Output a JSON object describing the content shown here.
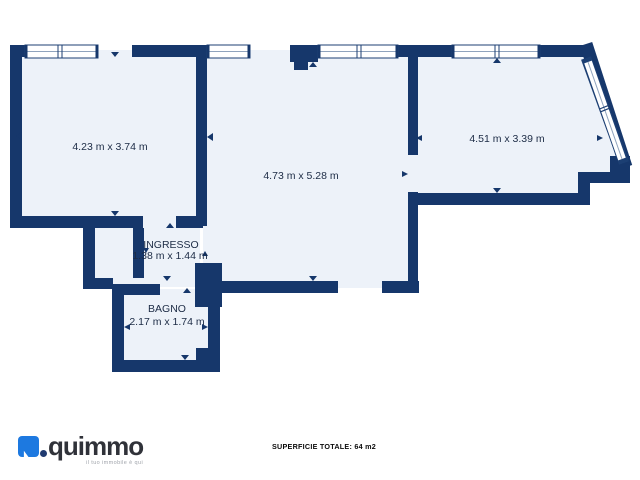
{
  "floorplan": {
    "rooms": [
      {
        "name": "",
        "label": "4.23 m x 3.74 m"
      },
      {
        "name": "",
        "label": "4.73 m x 5.28 m"
      },
      {
        "name": "",
        "label": "4.51 m x 3.39 m"
      },
      {
        "name": "INGRESSO",
        "label": "1.38 m x 1.44 m"
      },
      {
        "name": "BAGNO",
        "label": "2.17 m x 1.74 m"
      }
    ],
    "total_label": "SUPERFICIE TOTALE: 64 m2"
  },
  "branding": {
    "name": "quimmo",
    "tagline": "il tuo immobile è qui"
  },
  "colors": {
    "wall": "#16376b",
    "room_fill": "#edf2f9",
    "window_glass_line": "#8fa3bd",
    "label_text": "#1c2b45",
    "logo_blue": "#1d79e0",
    "logo_dot": "#203a70",
    "logo_text": "#303239"
  }
}
